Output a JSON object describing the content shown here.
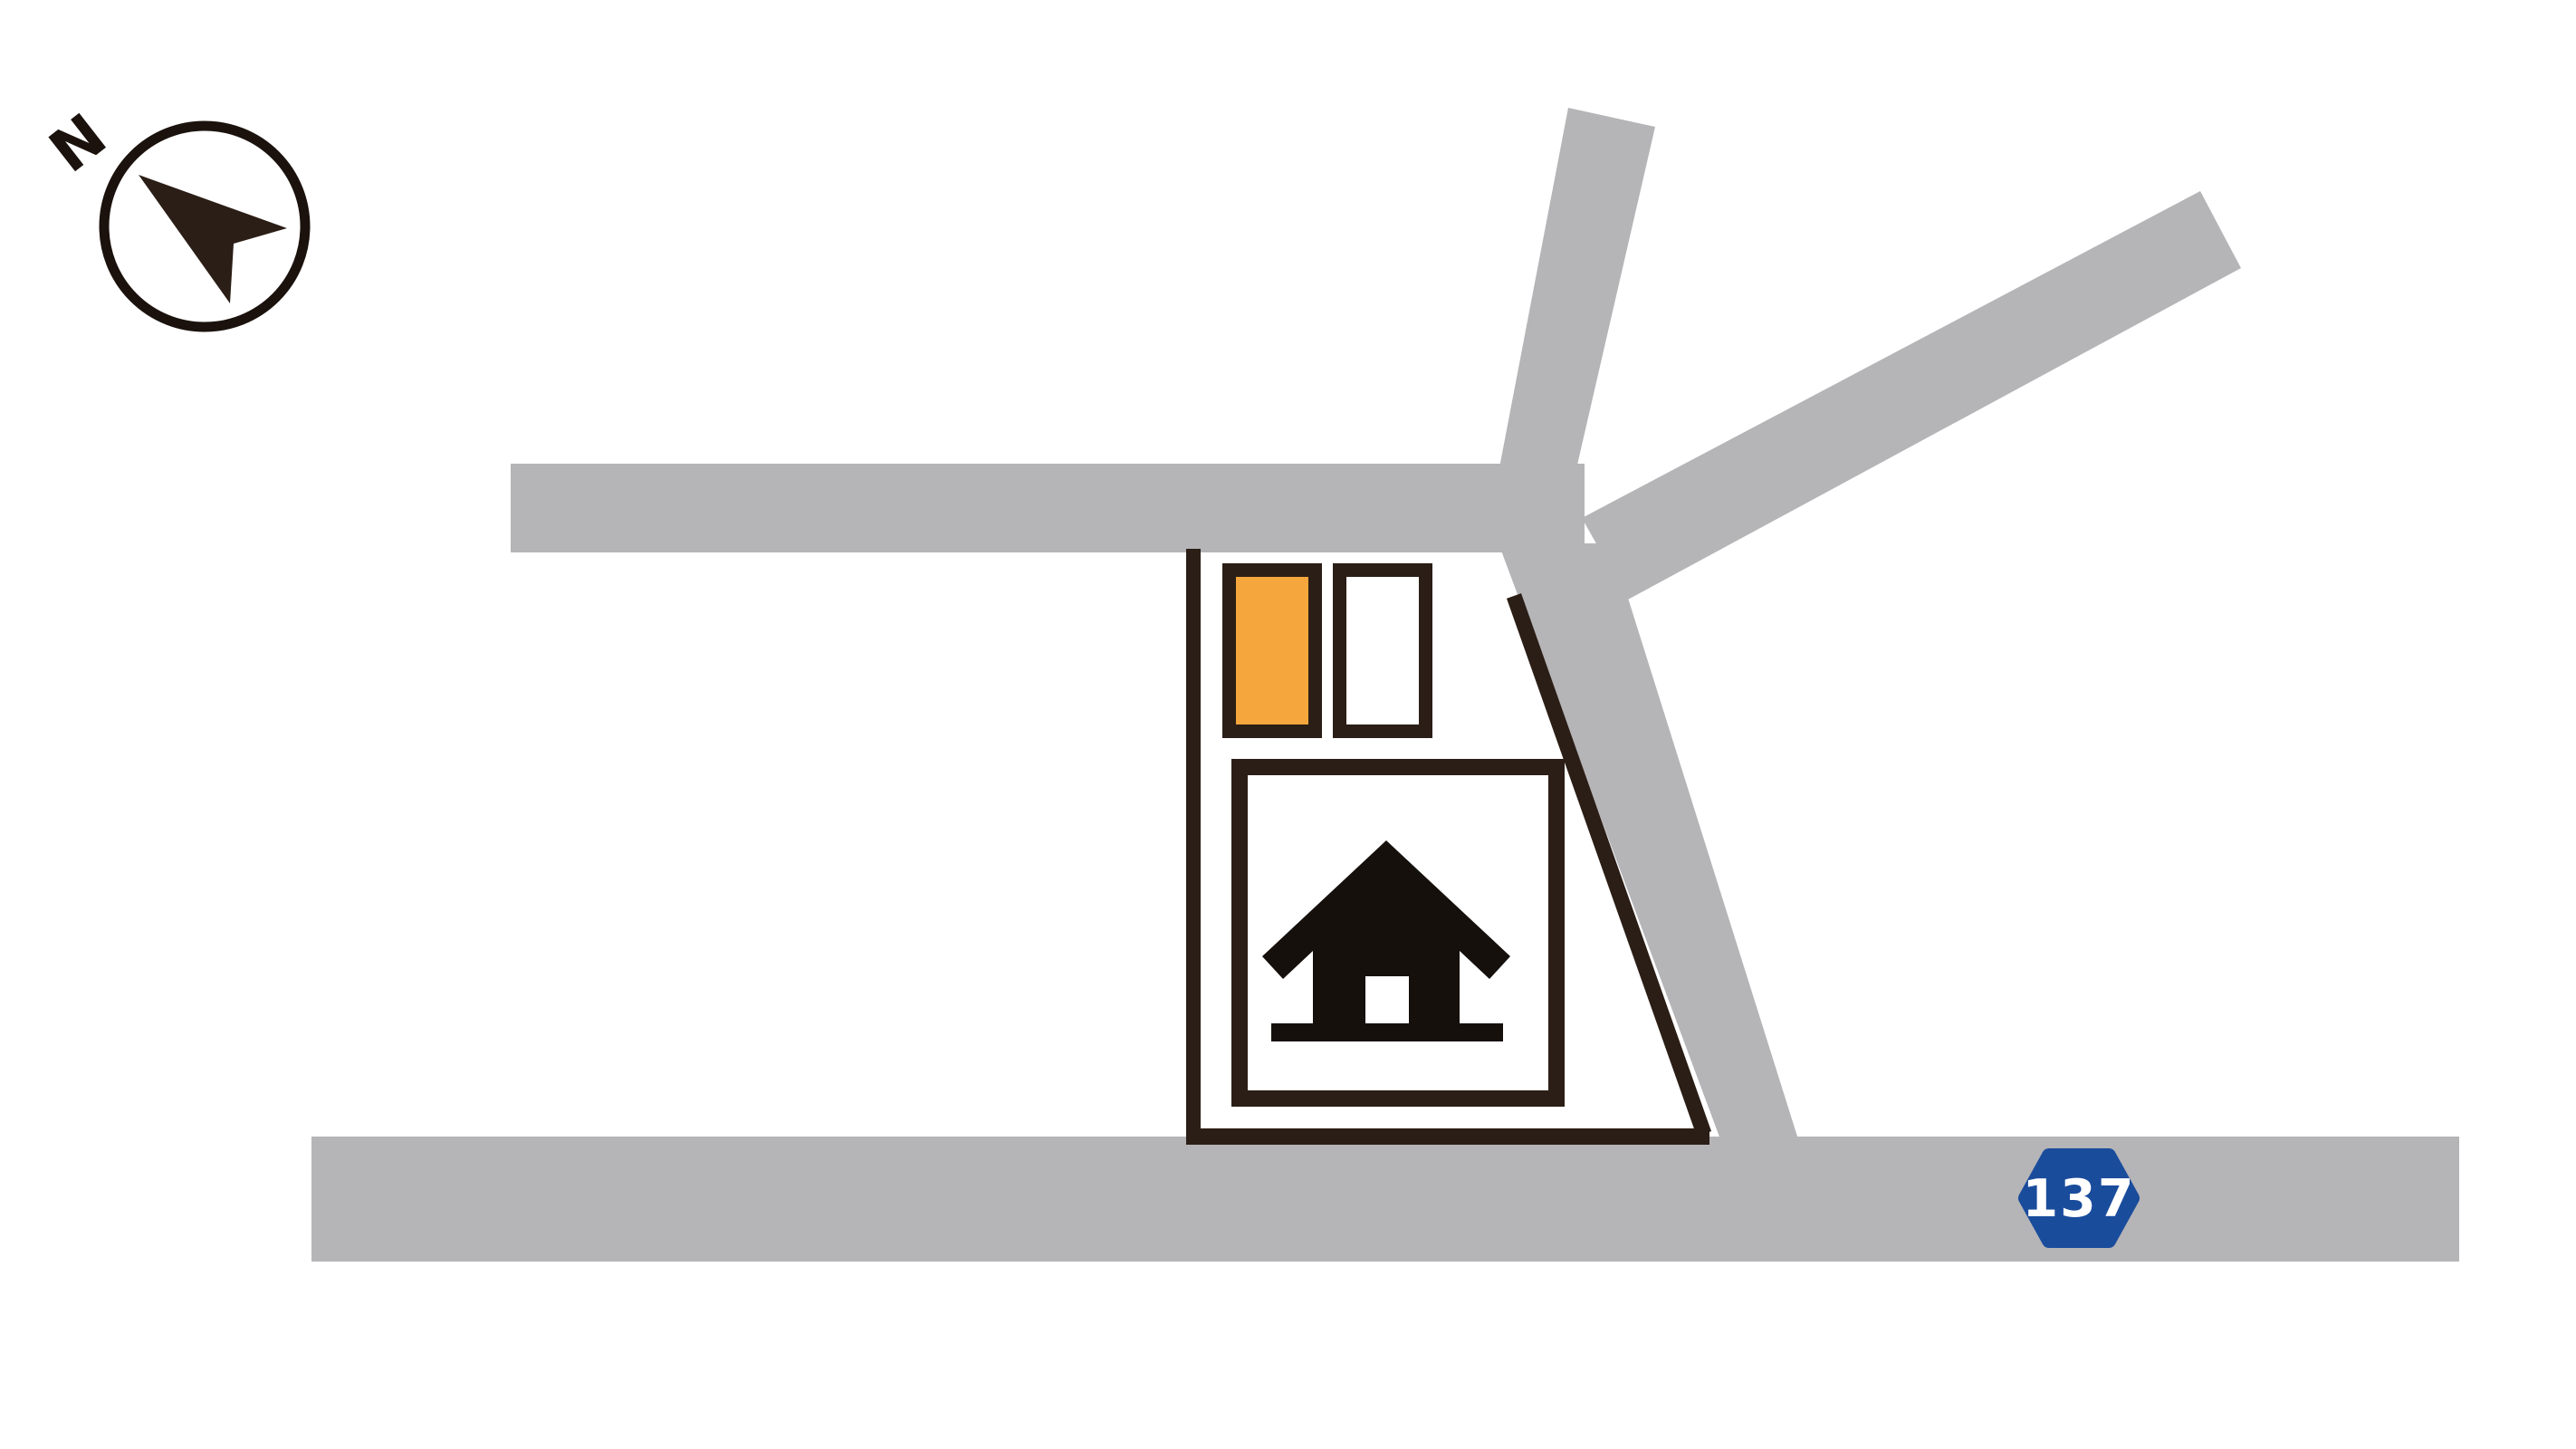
{
  "map": {
    "type": "site-access-map",
    "compass": {
      "label": "N",
      "icon": "north-arrow-icon"
    },
    "route_badge": {
      "number": "137",
      "shape": "rounded-hexagon-route-sign"
    },
    "plot": {
      "stalls": [
        {
          "id": "stall-highlighted",
          "highlighted": true
        },
        {
          "id": "stall-plain",
          "highlighted": false
        }
      ],
      "building_icon": "home-icon"
    },
    "colors": {
      "background": "#ffffff",
      "road": "#b5b4b7",
      "outline": "#2b1e16",
      "stall_orange": "#f5a63c",
      "house_black": "#15100c",
      "badge_blue": "#1a4c9c",
      "badge_text": "#ffffff",
      "compass_ink": "#1b120d"
    }
  }
}
